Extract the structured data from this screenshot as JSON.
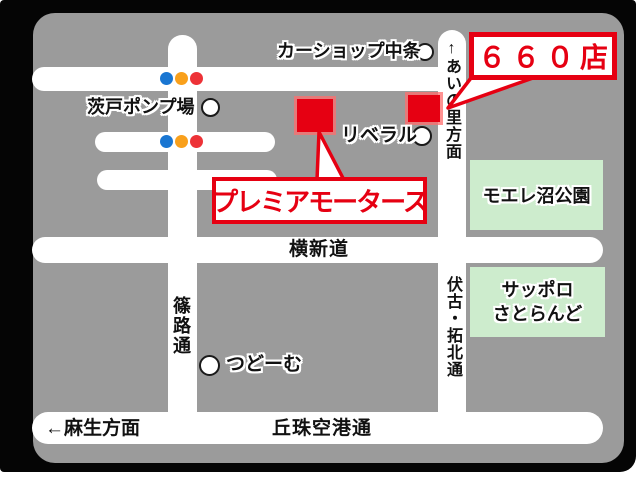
{
  "colors": {
    "frame": "#050505",
    "map_bg": "#9b9b9b",
    "road": "#ffffff",
    "accent_red": "#e60012",
    "area_green": "#cdeccd",
    "signal_blue": "#1976d2",
    "signal_yellow": "#f9a01b",
    "signal_red": "#ed3237"
  },
  "callouts": {
    "store_660": "６６０店",
    "premier_motors": "プレミアモータース"
  },
  "landmarks": {
    "car_shop_nakajo": "カーショップ中条",
    "barato_pump_station": "茨戸ポンプ場",
    "liberal": "リベラル",
    "tsudome": "つどーむ",
    "moere_numa_park": "モエレ沼公園",
    "sapporo_satoland_line1": "サッポロ",
    "sapporo_satoland_line2": "さとらんど"
  },
  "roads": {
    "ainosato_direction": "↑あいの里方面",
    "yokoshindo": "横新道",
    "fushiko_takuhoku_dori": "伏古・拓北通",
    "shinoro_dori": "篠路通",
    "asabu_direction": "←麻生方面",
    "okadama_airport_dori": "丘珠空港通"
  }
}
